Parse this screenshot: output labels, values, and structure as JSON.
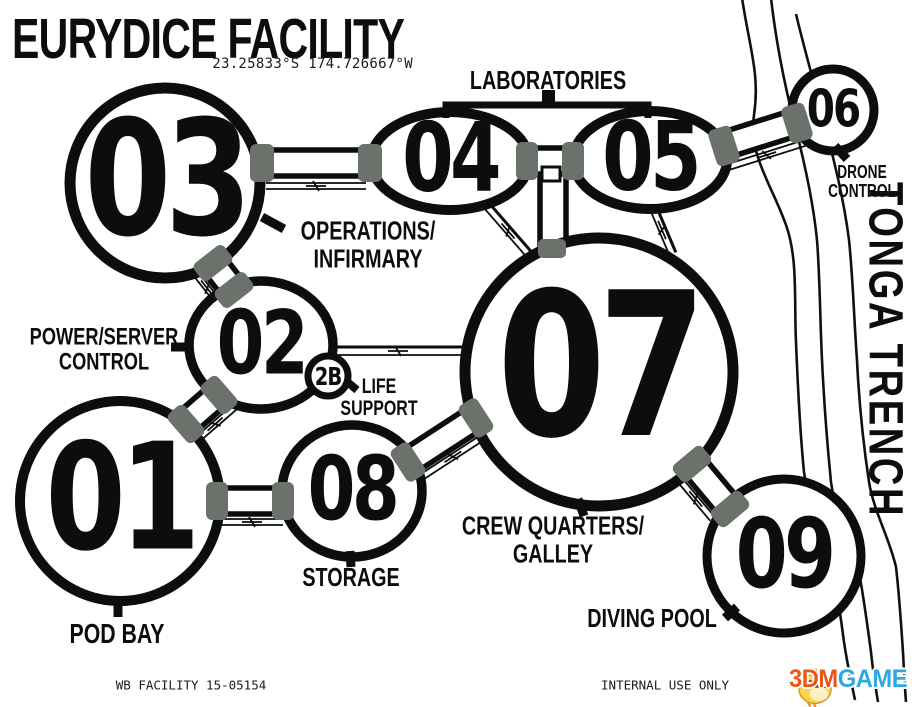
{
  "header": {
    "title": "EURYDICE FACILITY",
    "coordinates": "23.25833°S 174.726667°W"
  },
  "nodes": {
    "n01": "01",
    "n02": "02",
    "n2b": "2B",
    "n03": "03",
    "n04": "04",
    "n05": "05",
    "n06": "06",
    "n07": "07",
    "n08": "08",
    "n09": "09"
  },
  "labels": {
    "laboratories": "LABORATORIES",
    "operations_1": "OPERATIONS/",
    "operations_2": "INFIRMARY",
    "power_1": "POWER/SERVER",
    "power_2": "CONTROL",
    "life_1": "LIFE",
    "life_2": "SUPPORT",
    "crew_1": "CREW QUARTERS/",
    "crew_2": "GALLEY",
    "storage": "STORAGE",
    "pod_bay": "POD BAY",
    "diving_pool": "DIVING POOL",
    "drone_1": "DRONE",
    "drone_2": "CONTROL",
    "trench": "TONGA TRENCH"
  },
  "footer": {
    "left": "WB FACILITY 15-05154",
    "right": "INTERNAL USE ONLY"
  },
  "watermark": {
    "brand_3dm": "3DM",
    "brand_game": "GAME",
    "mascot": "chick-mascot-icon"
  },
  "colors": {
    "ink": "#0d0d0d",
    "docking_pad": "#6b726c",
    "brand_orange": "#e8571a",
    "brand_blue": "#2da9e1"
  }
}
